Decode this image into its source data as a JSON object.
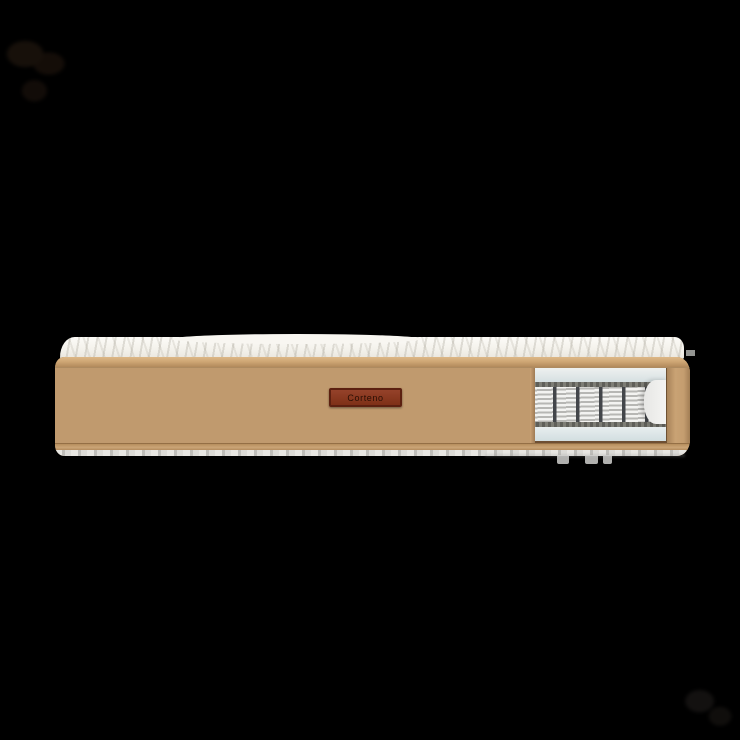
{
  "image": {
    "kind": "product-photo",
    "subject": "mattress side view with pocket-spring cutaway",
    "background_color": "#000000"
  },
  "mattress": {
    "label": {
      "text": "Corteno",
      "background_color": "#8a3a23",
      "border_color": "#5c2010",
      "text_color": "#2a0e03"
    },
    "fabric_color": "#c09a6e",
    "piping_color": "#cfa775",
    "top_quilt_color": "#f3f1ea",
    "foam_color": "#dfe7e8",
    "felt_color": "#6e6e67",
    "spring_color": "#ececea",
    "pocket_divider_color": "#43464a",
    "bottom_strip_color": "#dcdbd7",
    "cutaway": {
      "visible_pockets": 6
    },
    "side_seam_lines": 17
  },
  "watermarks": {
    "top_left": "faint-dark-blob",
    "bottom_right": "faint-dark-blob"
  }
}
